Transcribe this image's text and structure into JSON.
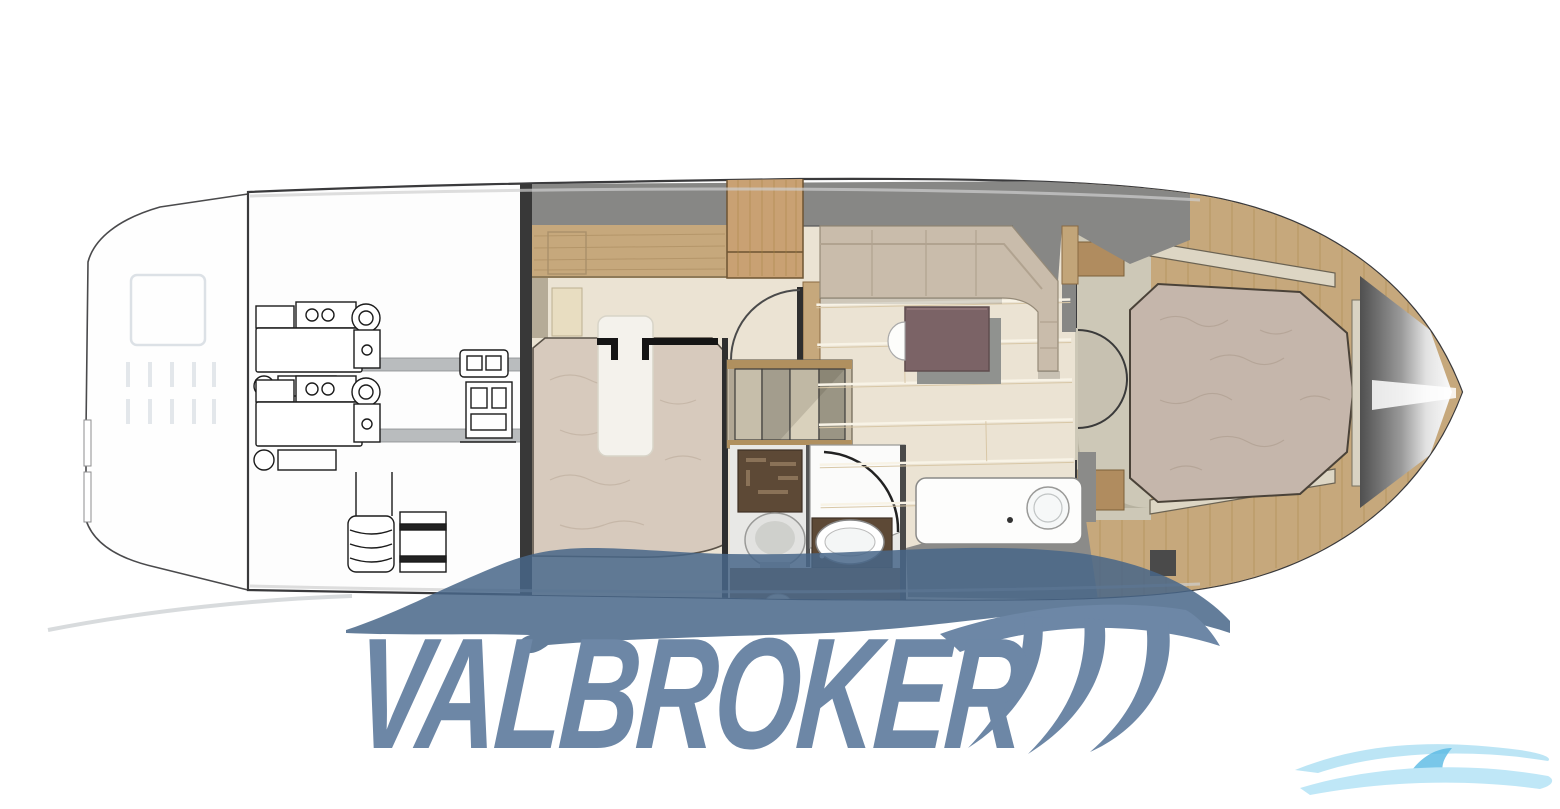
{
  "page": {
    "background": "#ffffff",
    "width_px": 1560,
    "height_px": 809,
    "description": "Yacht interior deck plan, overhead view, bow pointing right"
  },
  "branding": {
    "logo_text": "VALBROKER",
    "logo_color": "#6d87a6",
    "logo_overlay_color": "rgba(72,102,136,0.85)",
    "logo_style": "heavy condensed italic wordmark with hull swoosh above and three wave slashes at right",
    "corner_watermark_colors": {
      "upper_wave": "#a5dcf2",
      "fin": "#58b9e4",
      "lower_wave": "#bfe7f7"
    }
  },
  "plan": {
    "orientation": "bow-right",
    "regions": [
      "swim-platform",
      "engine-room",
      "galley",
      "mid-cabin-berth",
      "staircase",
      "bathroom",
      "vanity-counter",
      "dinette-salon",
      "bow-master-cabin",
      "side-decks",
      "bow-locker"
    ],
    "colors": {
      "hull_outline": "#3a3a3c",
      "deck_gray": "#878785",
      "wood_oak": "#c6a87c",
      "wood_grain": "#a3823f",
      "floor_cream": "#ebe3d3",
      "floor_planks": "#eee3cb",
      "sofa_beige": "#c9bcab",
      "table_mauve": "#7b6366",
      "bed_beige": "#d7cabd",
      "bow_bed_beige": "#c5b6ab",
      "walnut_dark": "#5d4936",
      "walkway_sage": "#c9c4b3",
      "stair_tread_light": "#e0d8c3",
      "stair_tread_dark": "#a9a493"
    }
  }
}
